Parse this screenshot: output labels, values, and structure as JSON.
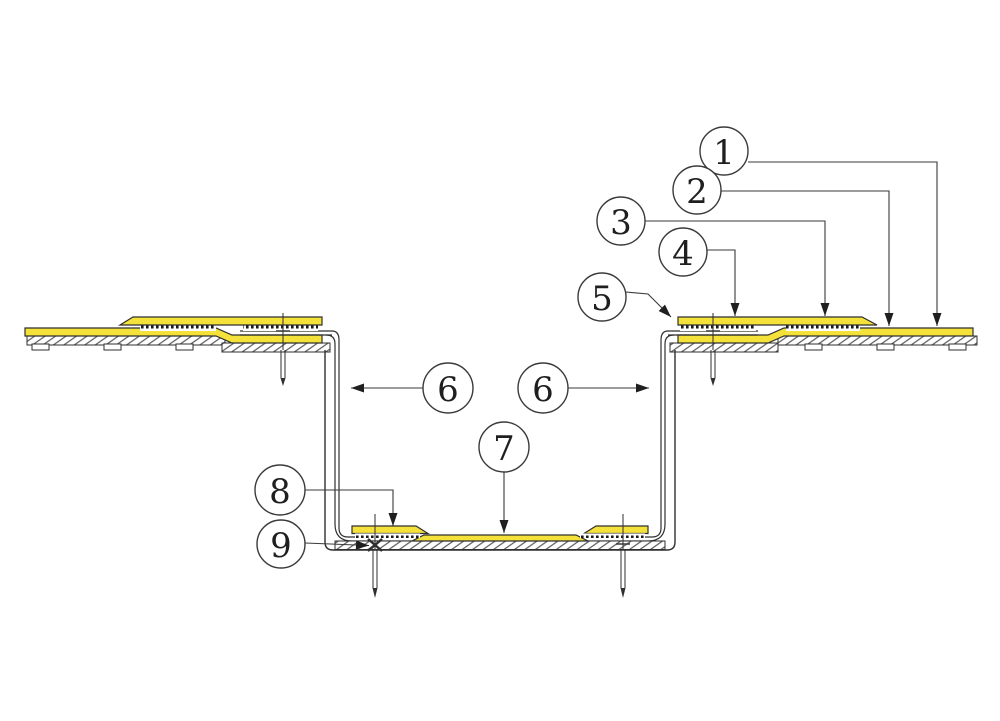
{
  "drawing": {
    "type": "construction-detail-section",
    "colors": {
      "membrane_yellow": "#f4e23b",
      "line_dark": "#2f2f2f",
      "leader_line": "#3a3a3a",
      "background": "#ffffff"
    },
    "callouts": [
      {
        "id": "callout-1",
        "label": "1"
      },
      {
        "id": "callout-2",
        "label": "2"
      },
      {
        "id": "callout-3",
        "label": "3"
      },
      {
        "id": "callout-4",
        "label": "4"
      },
      {
        "id": "callout-5",
        "label": "5"
      },
      {
        "id": "callout-6-left",
        "label": "6"
      },
      {
        "id": "callout-6-right",
        "label": "6"
      },
      {
        "id": "callout-7",
        "label": "7"
      },
      {
        "id": "callout-8",
        "label": "8"
      },
      {
        "id": "callout-9",
        "label": "9"
      }
    ]
  }
}
